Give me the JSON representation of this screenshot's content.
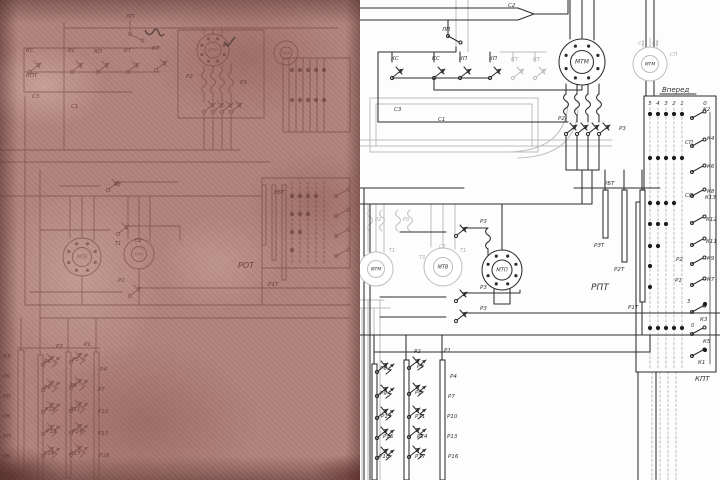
{
  "colors": {
    "paper": "#b0837b",
    "left_ink": "#6b4038",
    "right_ink": "#2c2c2c",
    "ghost": "#bdbdbd",
    "background": "#fdfdfd"
  },
  "left_panel": {
    "description_labels": [
      {
        "t": "ЛП",
        "x": 126,
        "y": 18
      },
      {
        "t": "КС",
        "x": 26,
        "y": 52
      },
      {
        "t": "КС",
        "x": 68,
        "y": 52
      },
      {
        "t": "КП",
        "x": 94,
        "y": 53
      },
      {
        "t": "КТ",
        "x": 124,
        "y": 52
      },
      {
        "t": "КТ",
        "x": 152,
        "y": 50
      },
      {
        "t": "КПТ",
        "x": 26,
        "y": 77
      },
      {
        "t": "С3",
        "x": 32,
        "y": 98
      },
      {
        "t": "С1",
        "x": 71,
        "y": 108
      },
      {
        "t": "Р2",
        "x": 186,
        "y": 78
      },
      {
        "t": "Р3",
        "x": 240,
        "y": 84
      },
      {
        "t": "Т1",
        "x": 115,
        "y": 245,
        "s": 5
      },
      {
        "t": "С2",
        "x": 135,
        "y": 242,
        "s": 5
      },
      {
        "t": "РОТ",
        "x": 238,
        "y": 268,
        "s": 8
      },
      {
        "t": "Р1Т",
        "x": 268,
        "y": 286
      },
      {
        "t": "РБТ",
        "x": 274,
        "y": 194
      },
      {
        "t": "Р3",
        "x": 114,
        "y": 186
      },
      {
        "t": "Р1",
        "x": 118,
        "y": 282
      },
      {
        "t": "Р2",
        "x": 56,
        "y": 348
      },
      {
        "t": "Р1",
        "x": 84,
        "y": 346
      },
      {
        "t": "Р6",
        "x": 44,
        "y": 363
      },
      {
        "t": "Р9",
        "x": 44,
        "y": 389
      },
      {
        "t": "Р12",
        "x": 45,
        "y": 411
      },
      {
        "t": "Р15",
        "x": 46,
        "y": 433
      },
      {
        "t": "Р18",
        "x": 44,
        "y": 455
      },
      {
        "t": "Р5",
        "x": 72,
        "y": 361
      },
      {
        "t": "Р8",
        "x": 70,
        "y": 387
      },
      {
        "t": "Р11",
        "x": 70,
        "y": 411
      },
      {
        "t": "Р14",
        "x": 72,
        "y": 433
      },
      {
        "t": "Р17",
        "x": 70,
        "y": 455
      },
      {
        "t": "Р4",
        "x": 100,
        "y": 371
      },
      {
        "t": "Р7",
        "x": 98,
        "y": 391
      },
      {
        "t": "Р10",
        "x": 98,
        "y": 413
      },
      {
        "t": "Р13",
        "x": 98,
        "y": 435
      },
      {
        "t": "Р16",
        "x": 99,
        "y": 457
      },
      {
        "t": "КЗ",
        "x": 3,
        "y": 358
      },
      {
        "t": "РБ",
        "x": 3,
        "y": 378
      },
      {
        "t": "РН",
        "x": 3,
        "y": 398
      },
      {
        "t": "РВ",
        "x": 3,
        "y": 418
      },
      {
        "t": "РП",
        "x": 3,
        "y": 438
      },
      {
        "t": "РБ",
        "x": 3,
        "y": 458
      },
      {
        "t": "РВ",
        "x": 3,
        "y": 476
      }
    ],
    "motors": [
      {
        "cx": 213,
        "cy": 50,
        "r": 16,
        "dots": true,
        "label": "МТМ"
      },
      {
        "cx": 286,
        "cy": 53,
        "r": 12,
        "dots": false,
        "label": "МТМ"
      },
      {
        "cx": 82,
        "cy": 257,
        "r": 19,
        "dots": true,
        "label": "МТВ"
      },
      {
        "cx": 139,
        "cy": 254,
        "r": 15,
        "dots": false,
        "label": "МТП"
      }
    ],
    "dot_rows": [
      {
        "y": 70,
        "positions": [
          5,
          4,
          3,
          2,
          1
        ]
      },
      {
        "y": 100,
        "positions": [
          5,
          4,
          3,
          2,
          1
        ]
      },
      {
        "y": 196,
        "positions": [
          5,
          4,
          3,
          2
        ]
      },
      {
        "y": 214,
        "positions": [
          5,
          4,
          3
        ]
      },
      {
        "y": 232,
        "positions": [
          5,
          4
        ]
      },
      {
        "y": 250,
        "positions": [
          5
        ]
      }
    ],
    "position_x_map": {
      "5": 292,
      "4": 300,
      "3": 308,
      "2": 316,
      "1": 324,
      "0": 340
    }
  },
  "right_panel": {
    "labels": [
      {
        "t": "С2",
        "x": 148,
        "y": 7
      },
      {
        "t": "ЛП",
        "x": 82,
        "y": 31
      },
      {
        "t": "КС",
        "x": 31,
        "y": 60
      },
      {
        "t": "КС",
        "x": 72,
        "y": 60
      },
      {
        "t": "КП",
        "x": 99,
        "y": 60
      },
      {
        "t": "КП",
        "x": 129,
        "y": 60
      },
      {
        "t": "КТ",
        "x": 151,
        "y": 61,
        "c": "g"
      },
      {
        "t": "КТ",
        "x": 173,
        "y": 61,
        "c": "g"
      },
      {
        "t": "С3",
        "x": 34,
        "y": 111
      },
      {
        "t": "С1",
        "x": 78,
        "y": 121
      },
      {
        "t": "С1",
        "x": 278,
        "y": 45,
        "c": "g",
        "s": 5
      },
      {
        "t": "С2",
        "x": 292,
        "y": 45,
        "c": "g",
        "s": 5
      },
      {
        "t": "СП",
        "x": 310,
        "y": 56,
        "c": "g",
        "s": 5
      },
      {
        "t": "Р2",
        "x": 198,
        "y": 120
      },
      {
        "t": "Р3",
        "x": 259,
        "y": 130
      },
      {
        "t": "К2",
        "x": 343,
        "y": 111
      },
      {
        "t": "СП",
        "x": 325,
        "y": 144
      },
      {
        "t": "К4",
        "x": 347,
        "y": 140
      },
      {
        "t": "К6",
        "x": 347,
        "y": 168
      },
      {
        "t": "СП",
        "x": 325,
        "y": 197
      },
      {
        "t": "К8",
        "x": 347,
        "y": 193
      },
      {
        "t": "РБТ",
        "x": 244,
        "y": 185
      },
      {
        "t": "К13",
        "x": 345,
        "y": 199
      },
      {
        "t": "К12",
        "x": 346,
        "y": 221
      },
      {
        "t": "К11",
        "x": 346,
        "y": 243
      },
      {
        "t": "Р2",
        "x": 316,
        "y": 261
      },
      {
        "t": "К9",
        "x": 347,
        "y": 260
      },
      {
        "t": "Р1",
        "x": 315,
        "y": 282
      },
      {
        "t": "К7",
        "x": 347,
        "y": 281
      },
      {
        "t": "З",
        "x": 327,
        "y": 303,
        "s": 5
      },
      {
        "t": "К3",
        "x": 340,
        "y": 321
      },
      {
        "t": "0",
        "x": 331,
        "y": 327,
        "s": 5
      },
      {
        "t": "К5",
        "x": 343,
        "y": 343
      },
      {
        "t": "К1",
        "x": 338,
        "y": 364
      },
      {
        "t": "КПТ",
        "x": 335,
        "y": 381,
        "s": 7
      },
      {
        "t": "РПТ",
        "x": 231,
        "y": 290,
        "s": 9
      },
      {
        "t": "РЗТ",
        "x": 234,
        "y": 247
      },
      {
        "t": "Р2Т",
        "x": 254,
        "y": 271
      },
      {
        "t": "Р1Т",
        "x": 268,
        "y": 309
      },
      {
        "t": "Т1",
        "x": 29,
        "y": 252,
        "c": "g",
        "s": 5
      },
      {
        "t": "Т3",
        "x": 59,
        "y": 259,
        "c": "g",
        "s": 5
      },
      {
        "t": "С2",
        "x": 79,
        "y": 248,
        "c": "g",
        "s": 5
      },
      {
        "t": "Т1",
        "x": 100,
        "y": 252,
        "c": "g",
        "s": 5
      },
      {
        "t": "Р2",
        "x": 15,
        "y": 221,
        "c": "g",
        "s": 5
      },
      {
        "t": "Р3",
        "x": 43,
        "y": 221,
        "c": "g",
        "s": 5
      },
      {
        "t": "Р3",
        "x": 120,
        "y": 223
      },
      {
        "t": "Р3",
        "x": 120,
        "y": 289
      },
      {
        "t": "Р3",
        "x": 120,
        "y": 310
      },
      {
        "t": "Р2",
        "x": 54,
        "y": 353
      },
      {
        "t": "Р1",
        "x": 84,
        "y": 352
      },
      {
        "t": "Р6",
        "x": 20,
        "y": 370
      },
      {
        "t": "Р9",
        "x": 20,
        "y": 395
      },
      {
        "t": "Р12",
        "x": 21,
        "y": 418
      },
      {
        "t": "Р15",
        "x": 23,
        "y": 438
      },
      {
        "t": "Р18",
        "x": 19,
        "y": 458
      },
      {
        "t": "Р5",
        "x": 57,
        "y": 368
      },
      {
        "t": "Р8",
        "x": 55,
        "y": 394
      },
      {
        "t": "Р11",
        "x": 55,
        "y": 418
      },
      {
        "t": "Р14",
        "x": 57,
        "y": 438
      },
      {
        "t": "Р17",
        "x": 55,
        "y": 458
      },
      {
        "t": "Р4",
        "x": 90,
        "y": 378
      },
      {
        "t": "Р7",
        "x": 88,
        "y": 398
      },
      {
        "t": "Р10",
        "x": 87,
        "y": 418
      },
      {
        "t": "Р13",
        "x": 87,
        "y": 438
      },
      {
        "t": "Р16",
        "x": 88,
        "y": 458
      }
    ],
    "motors": [
      {
        "cx": 222,
        "cy": 62,
        "r": 23,
        "dots": true,
        "style": "ink",
        "label": "МТМ"
      },
      {
        "cx": 290,
        "cy": 64,
        "r": 17,
        "dots": false,
        "style": "gry",
        "label": "МТМ"
      },
      {
        "cx": 16,
        "cy": 269,
        "r": 17,
        "dots": false,
        "style": "gry",
        "label": "МТМ"
      },
      {
        "cx": 83,
        "cy": 267,
        "r": 19,
        "dots": false,
        "style": "gry",
        "label": "МТВ"
      },
      {
        "cx": 142,
        "cy": 270,
        "r": 20,
        "dots": true,
        "style": "ink",
        "label": "МТП"
      }
    ],
    "controller": {
      "title": "Вперед",
      "positions": [
        "5",
        "4",
        "3",
        "2",
        "1",
        "0"
      ],
      "position_x_map": {
        "5": 290,
        "4": 298,
        "3": 306,
        "2": 314,
        "1": 322,
        "0": 345
      },
      "digits_y": 105,
      "dot_rows": [
        {
          "y": 114,
          "positions": [
            5,
            4,
            3,
            2,
            1
          ]
        },
        {
          "y": 158,
          "positions": [
            5,
            4,
            3,
            2,
            1
          ]
        },
        {
          "y": 203,
          "positions": [
            5,
            4,
            3,
            2
          ]
        },
        {
          "y": 224,
          "positions": [
            5,
            4,
            3
          ]
        },
        {
          "y": 246,
          "positions": [
            5,
            4
          ]
        },
        {
          "y": 266,
          "positions": [
            5
          ]
        },
        {
          "y": 287,
          "positions": [
            5
          ]
        },
        {
          "y": 304,
          "positions": [
            "0"
          ]
        },
        {
          "y": 328,
          "positions": [
            5,
            4,
            3,
            2,
            1
          ]
        },
        {
          "y": 350,
          "positions": [
            "0"
          ]
        }
      ]
    }
  }
}
